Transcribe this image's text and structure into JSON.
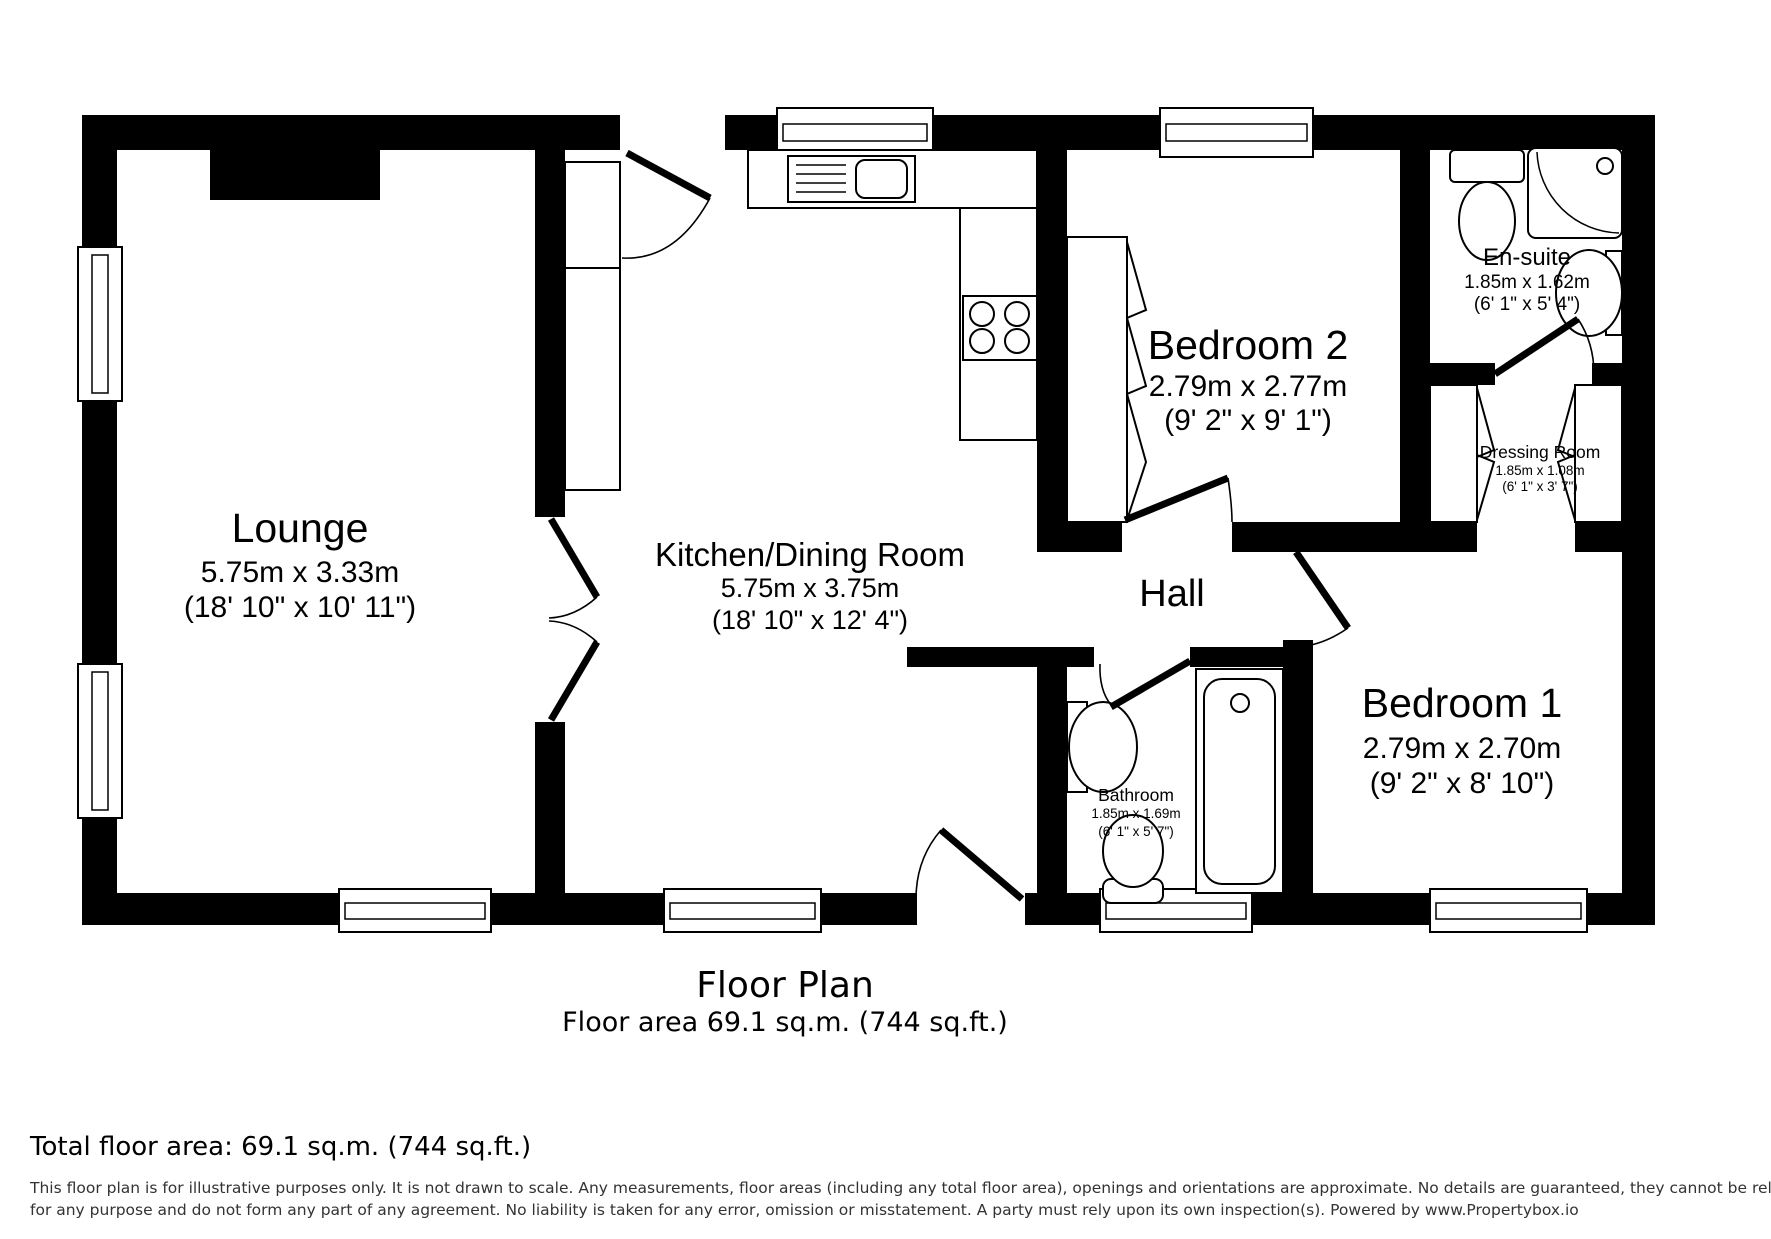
{
  "plan": {
    "title": "Floor Plan",
    "area_caption": "Floor area 69.1 sq.m. (744 sq.ft.)",
    "rooms": {
      "lounge": {
        "name": "Lounge",
        "metric": "5.75m x 3.33m",
        "imperial": "(18' 10\" x 10' 11\")"
      },
      "kitchen_dining": {
        "name": "Kitchen/Dining Room",
        "metric": "5.75m x 3.75m",
        "imperial": "(18' 10\" x 12' 4\")"
      },
      "hall": {
        "name": "Hall"
      },
      "bedroom2": {
        "name": "Bedroom 2",
        "metric": "2.79m x 2.77m",
        "imperial": "(9' 2\" x 9' 1\")"
      },
      "ensuite": {
        "name": "En-suite",
        "metric": "1.85m x 1.62m",
        "imperial": "(6' 1\" x 5' 4\")"
      },
      "dressing_room": {
        "name": "Dressing Room",
        "metric": "1.85m x 1.08m",
        "imperial": "(6' 1\" x 3' 7\")"
      },
      "bathroom": {
        "name": "Bathroom",
        "metric": "1.85m x 1.69m",
        "imperial": "(6' 1\" x 5' 7\")"
      },
      "bedroom1": {
        "name": "Bedroom 1",
        "metric": "2.79m x 2.70m",
        "imperial": "(9' 2\" x 8' 10\")"
      }
    }
  },
  "footer": {
    "total_area": "Total floor area: 69.1 sq.m. (744 sq.ft.)",
    "disclaimer_line1": "This floor plan is for illustrative purposes only. It is not drawn to scale. Any measurements, floor areas (including any total floor area), openings and orientations are approximate. No details are guaranteed, they cannot be relied upon",
    "disclaimer_line2": "for any purpose and do not form any part of any agreement. No liability is taken for any error, omission or misstatement. A party must rely upon its own inspection(s). Powered by www.Propertybox.io"
  },
  "colors": {
    "walls": "#000000",
    "background": "#ffffff",
    "disclaimer_text": "#333333"
  }
}
